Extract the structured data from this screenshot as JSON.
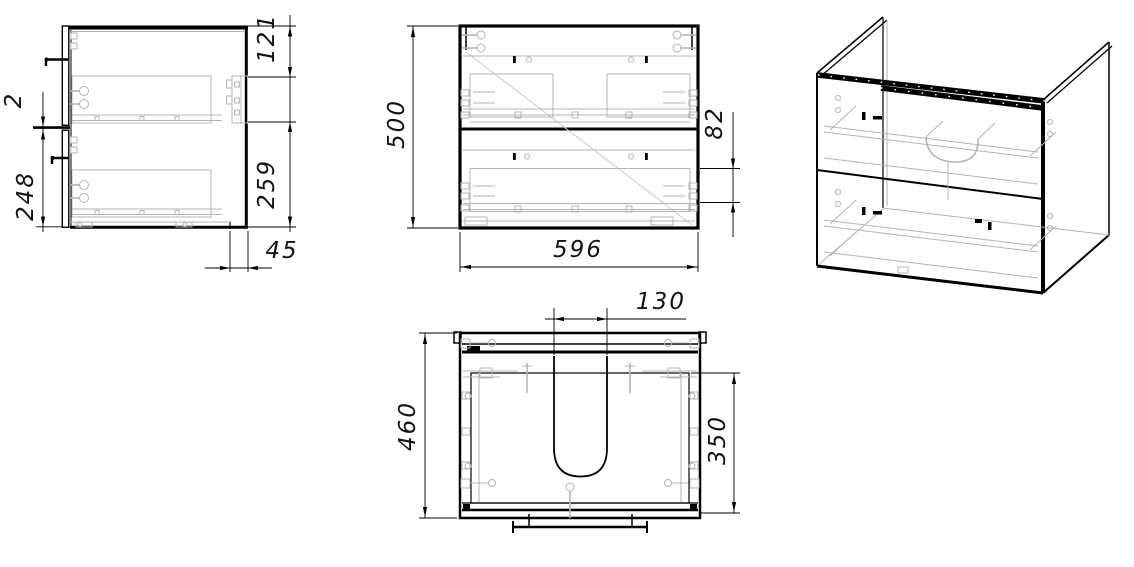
{
  "drawing": {
    "colors": {
      "line": "#000000",
      "detail": "#b4b4b4",
      "background": "#ffffff"
    },
    "side_view": {
      "dims": {
        "front_gap": "2",
        "lower_front_height": "248",
        "top_to_bracket": "121",
        "bracket_to_bottom": "259",
        "bottom_back_offset": "45"
      }
    },
    "front_view": {
      "dims": {
        "height": "500",
        "width": "596",
        "drawer_box_height": "82"
      }
    },
    "plan_view": {
      "dims": {
        "cutout_width": "130",
        "depth": "460",
        "cutout_depth": "350"
      }
    }
  }
}
